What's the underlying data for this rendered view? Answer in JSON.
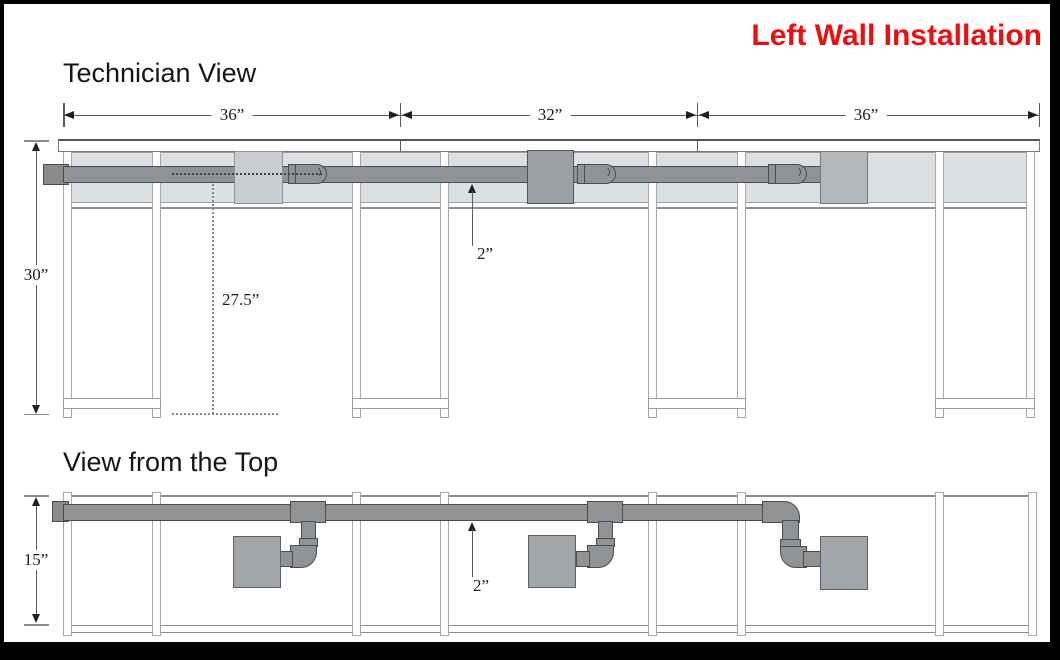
{
  "header": {
    "title": "Left Wall Installation"
  },
  "tech_view": {
    "label": "Technician View",
    "width_dims": [
      "36”",
      "32”",
      "36”"
    ],
    "height_dim": "30”",
    "pipe_center_height_dim": "27.5”",
    "pipe_size_dim": "2”"
  },
  "top_view": {
    "label": "View from the Top",
    "depth_dim": "15”",
    "pipe_size_dim": "2”"
  },
  "colors": {
    "title_red": "#ee0e0e",
    "pipe_gray": "#8f9396",
    "panel_gray": "#dde0e3",
    "box_light_gray": "#c9cdd1",
    "box_dark_gray": "#9aa0a4",
    "box_medium_gray": "#b4b8bb",
    "line_gray": "#5a5a5a"
  }
}
